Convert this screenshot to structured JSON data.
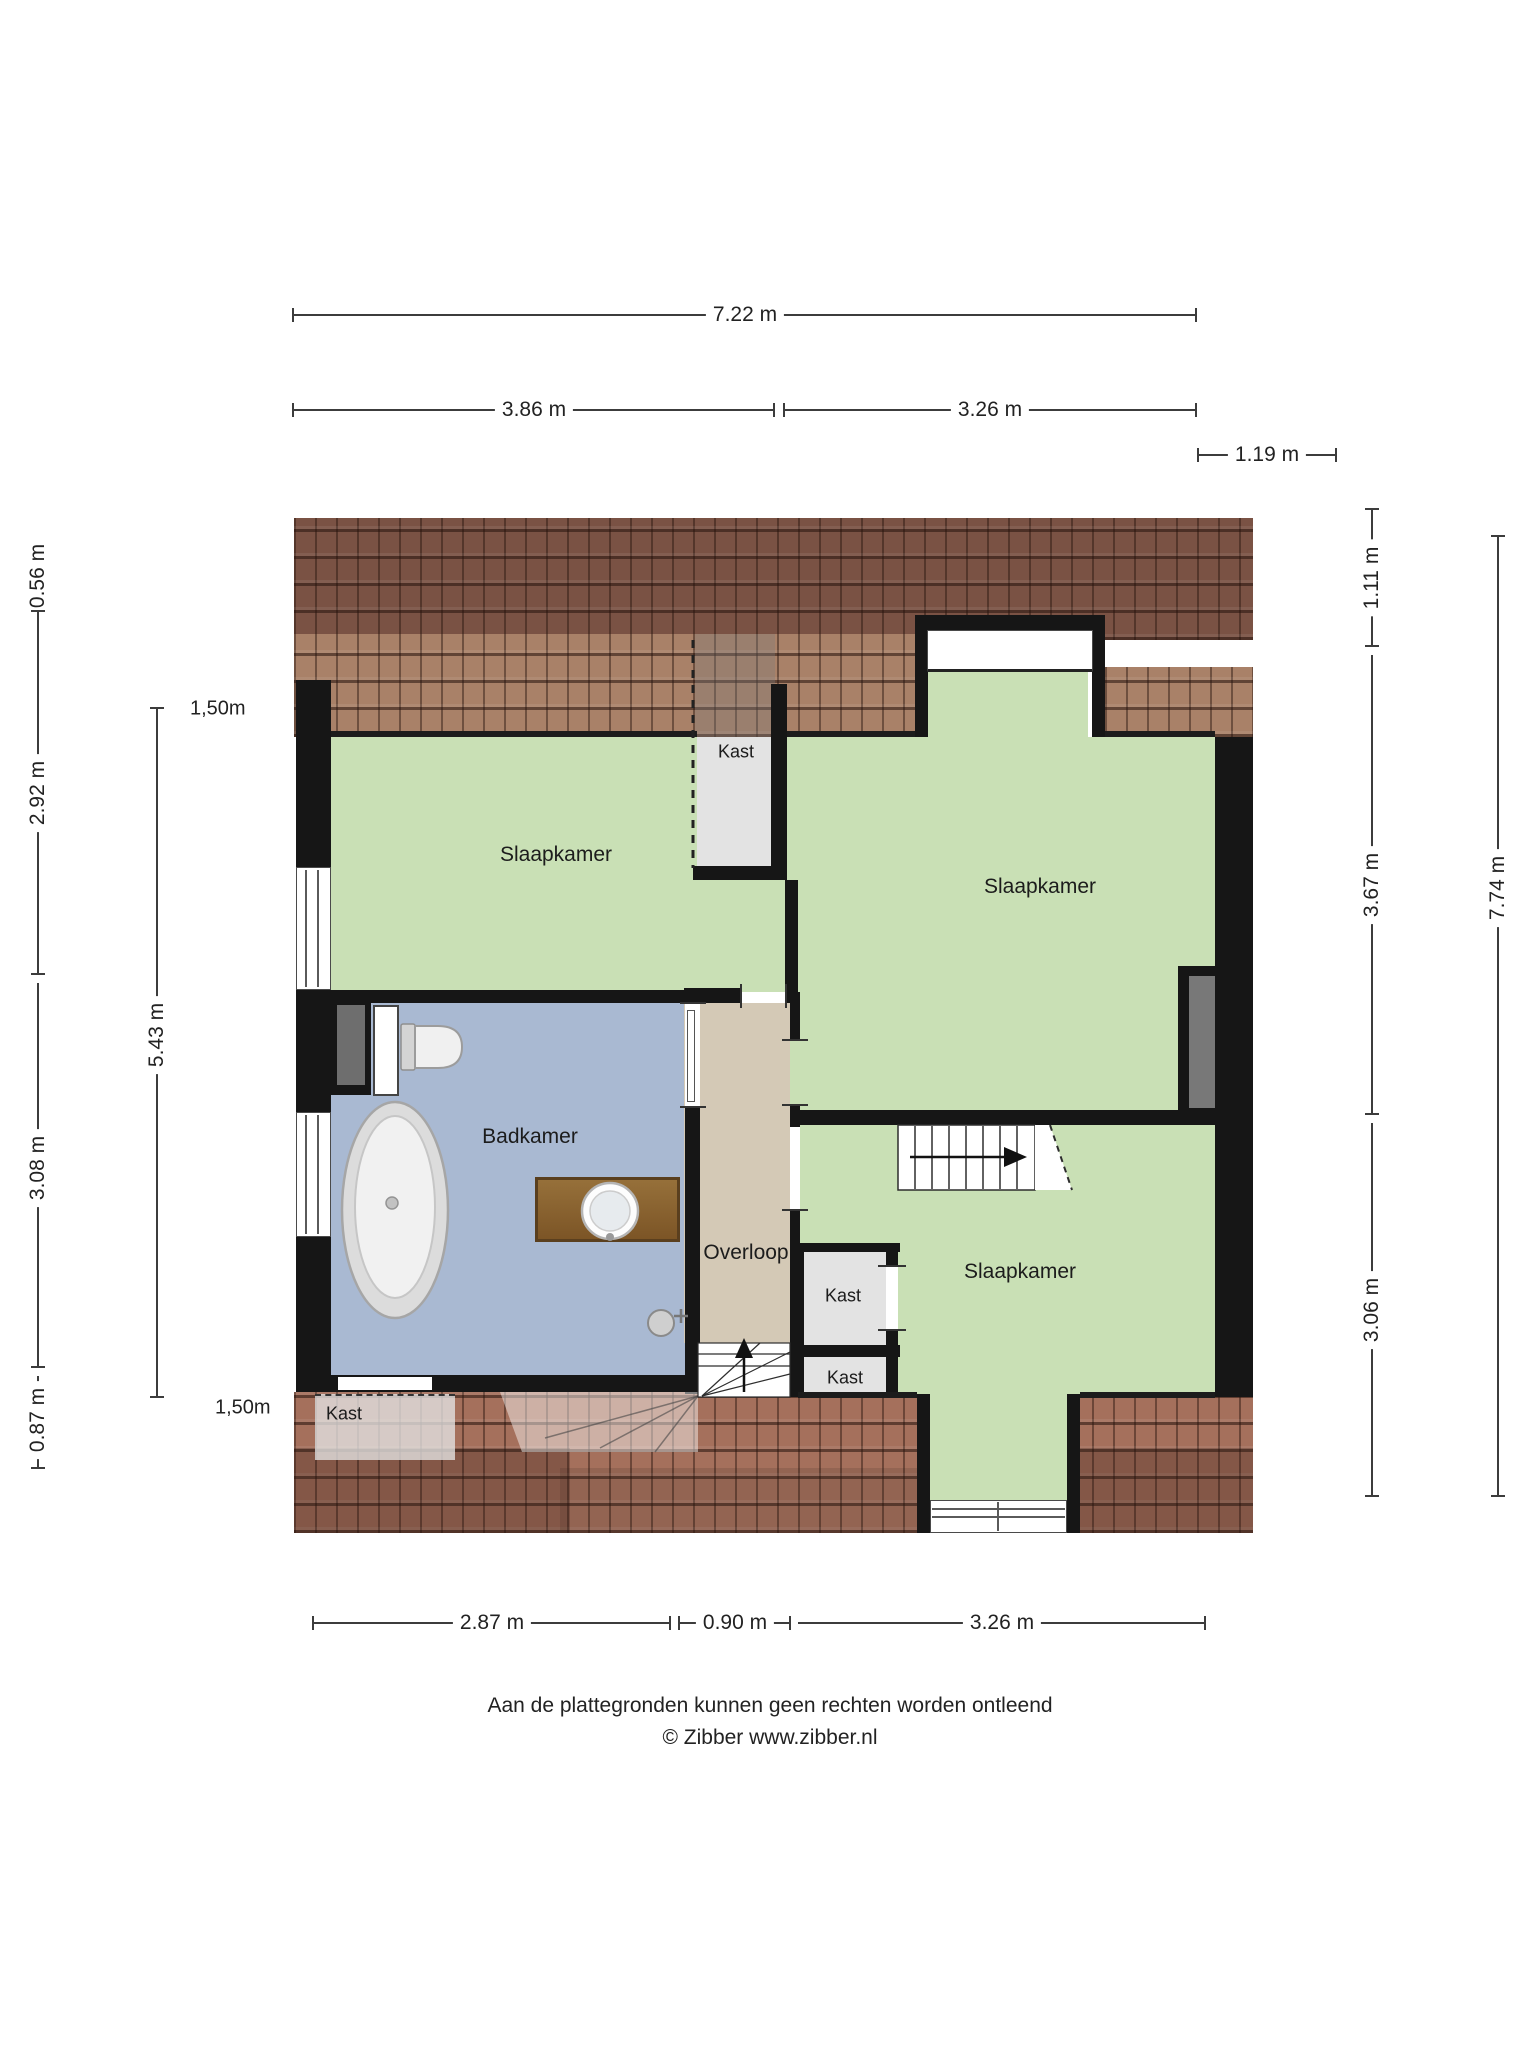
{
  "rooms": {
    "slaapkamer_topleft": {
      "label": "Slaapkamer"
    },
    "slaapkamer_topright": {
      "label": "Slaapkamer"
    },
    "slaapkamer_bottomright": {
      "label": "Slaapkamer"
    },
    "badkamer": {
      "label": "Badkamer"
    },
    "overloop": {
      "label": "Overloop"
    },
    "kast_top": {
      "label": "Kast"
    },
    "kast_mid": {
      "label": "Kast"
    },
    "kast_lower": {
      "label": "Kast"
    },
    "kast_bottomleft": {
      "label": "Kast"
    }
  },
  "dimensions": {
    "top_total": {
      "label": "7.22 m"
    },
    "top_left": {
      "label": "3.86 m"
    },
    "top_right": {
      "label": "3.26 m"
    },
    "top_overhang": {
      "label": "1.19 m"
    },
    "left_outer": [
      {
        "label": "0.56 m"
      },
      {
        "label": "2.92 m"
      },
      {
        "label": "3.08 m"
      },
      {
        "label": "0.87 m"
      }
    ],
    "left_inner": {
      "label": "5.43 m"
    },
    "right_inner": [
      {
        "label": "1.11 m"
      },
      {
        "label": "3.67 m"
      },
      {
        "label": "3.06 m"
      }
    ],
    "right_outer": {
      "label": "7.74 m"
    },
    "bottom": [
      {
        "label": "2.87 m"
      },
      {
        "label": "0.90 m"
      },
      {
        "label": "3.26 m"
      }
    ],
    "headroom_top": {
      "label": "1,50m"
    },
    "headroom_bottom": {
      "label": "1,50m"
    }
  },
  "footer": {
    "disclaimer": "Aan de plattegronden kunnen geen rechten worden ontleend",
    "copyright": "© Zibber www.zibber.nl"
  },
  "colors": {
    "wall": "#161616",
    "floor_green": "#c9e0b5",
    "floor_blue": "#a9b9d2",
    "floor_beige": "#d4c9b6",
    "floor_closet": "#e3e3e3",
    "roof_dark": "#7a5244",
    "roof_light": "#a98168",
    "roof_bottom": "#a5705c",
    "dim_line": "#3c3c3c"
  }
}
